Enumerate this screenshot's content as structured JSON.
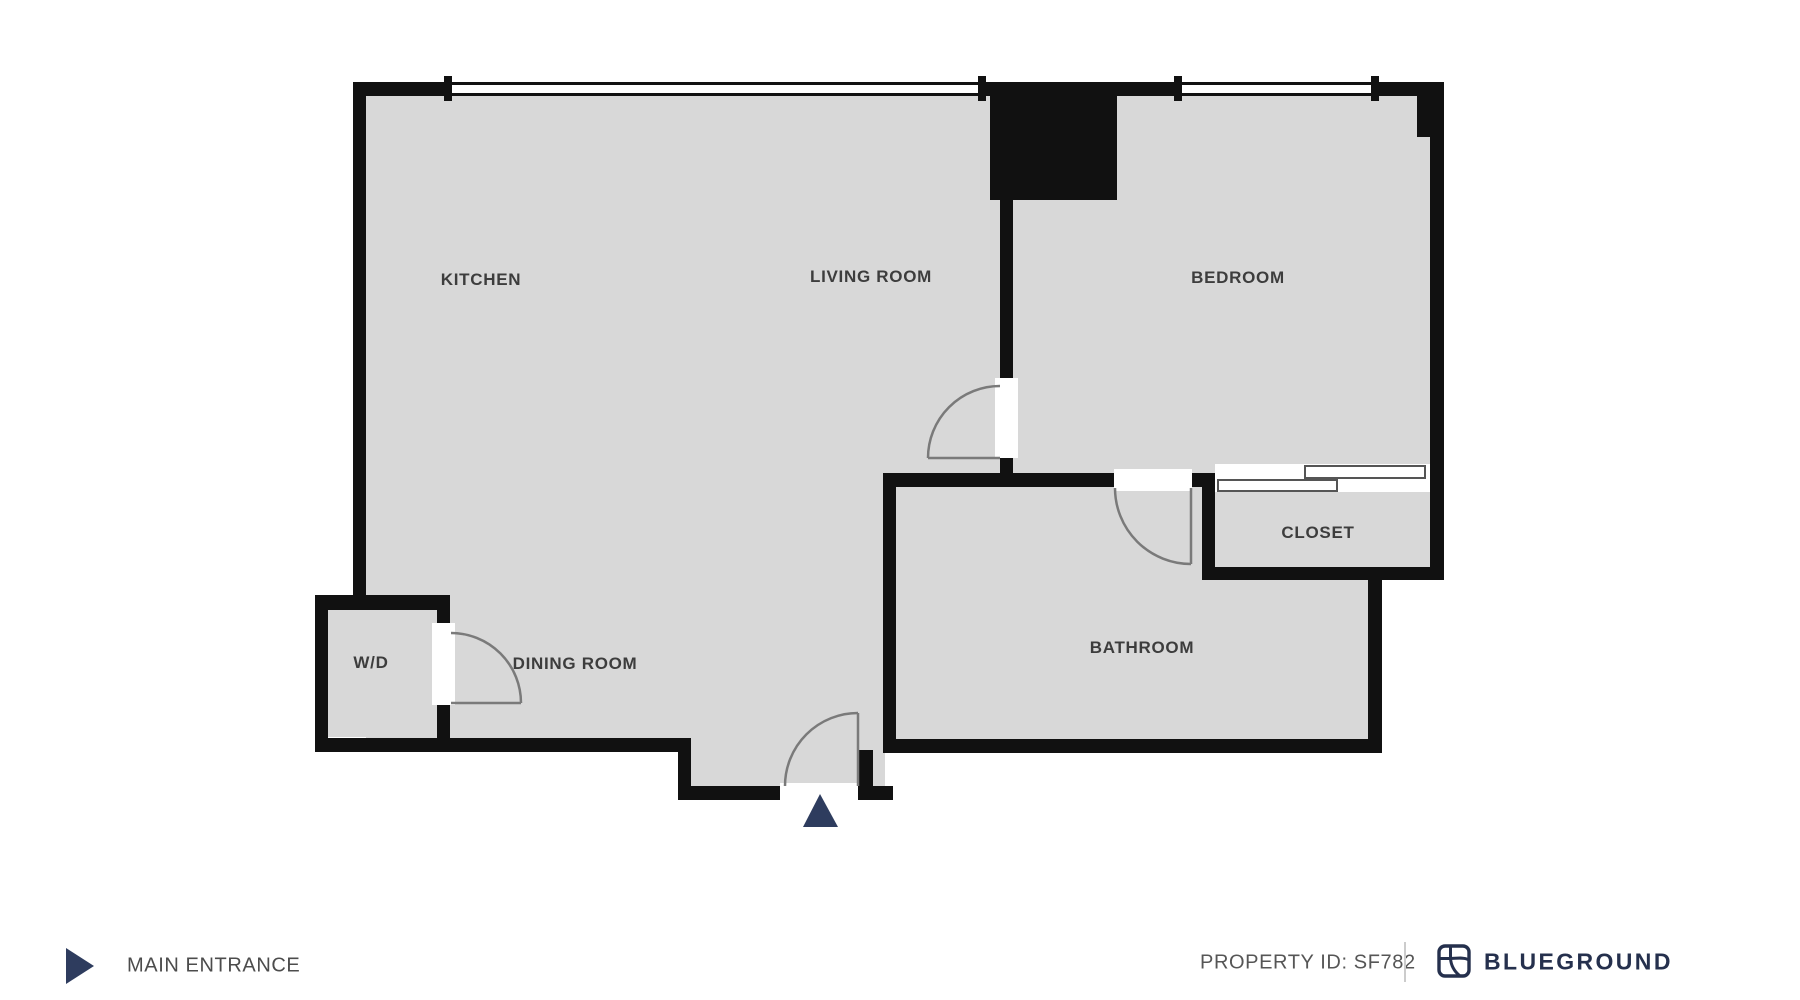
{
  "title": "Apartment floor plan",
  "rooms": [
    {
      "id": "kitchen",
      "label": "KITCHEN"
    },
    {
      "id": "living-room",
      "label": "LIVING ROOM"
    },
    {
      "id": "bedroom",
      "label": "BEDROOM"
    },
    {
      "id": "closet",
      "label": "CLOSET"
    },
    {
      "id": "bathroom",
      "label": "BATHROOM"
    },
    {
      "id": "dining-room",
      "label": "DINING ROOM"
    },
    {
      "id": "washer-dryer",
      "label": "W/D"
    }
  ],
  "doors": [
    {
      "between": "living-room/bedroom"
    },
    {
      "between": "hall/bathroom"
    },
    {
      "between": "dining-room/washer-dryer"
    },
    {
      "between": "exterior/main-entrance"
    }
  ],
  "windows": [
    {
      "wall": "top",
      "rooms": "kitchen+living-room"
    },
    {
      "wall": "top",
      "rooms": "bedroom"
    }
  ],
  "footer": {
    "main_entrance_label": "MAIN ENTRANCE",
    "property_id_label": "PROPERTY ID: SF782",
    "brand_name": "BLUEGROUND"
  },
  "icons": {
    "entrance_arrow": "right-pointing-triangle",
    "entrance_marker": "up-pointing-triangle",
    "brand_logo": "blueground-rounded-square-monogram"
  },
  "colors": {
    "wall": "#111111",
    "floor": "#d8d8d8",
    "door_line": "#7a7a7a",
    "accent_navy": "#2e3c5e",
    "brand_navy": "#25304d",
    "footer_text": "#4c4c4c",
    "divider": "#cccccc",
    "background": "#ffffff"
  }
}
